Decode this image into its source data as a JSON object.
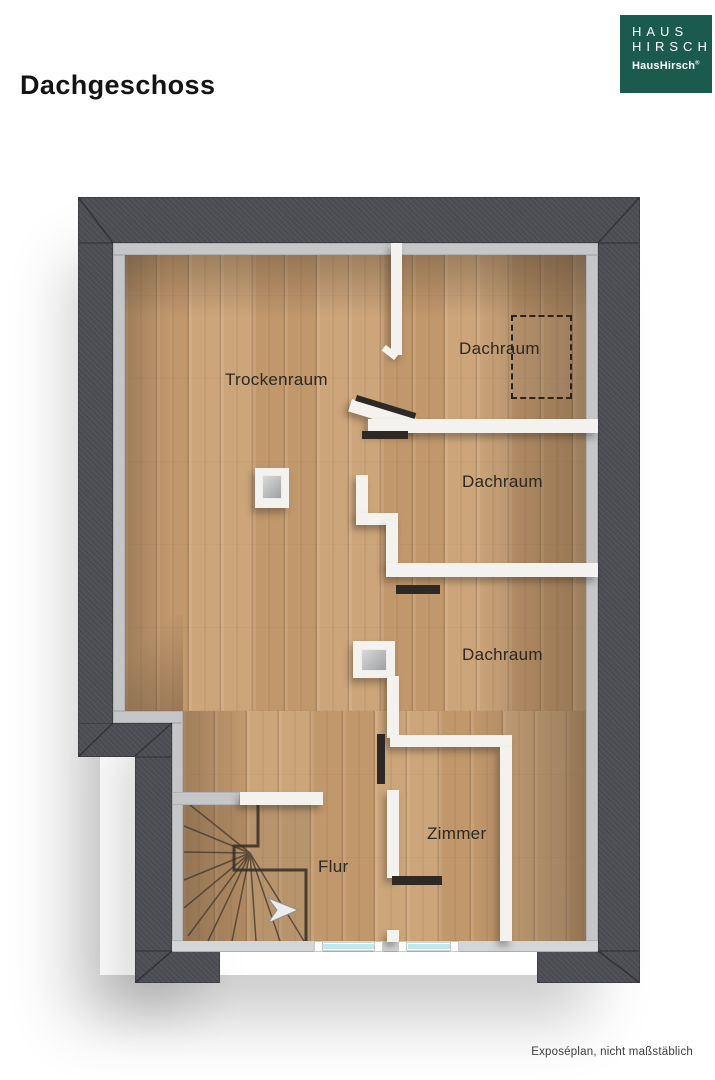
{
  "header": {
    "title": "Dachgeschoss"
  },
  "logo": {
    "line1": "HAUS",
    "line2": "HIRSCH",
    "wordmark": "HausHirsch",
    "trademark": "®"
  },
  "plan": {
    "floor_name": "Dachgeschoss",
    "rooms": [
      {
        "id": "trockenraum",
        "label": "Trockenraum"
      },
      {
        "id": "dachraum-oben",
        "label": "Dachraum"
      },
      {
        "id": "dachraum-mitte",
        "label": "Dachraum"
      },
      {
        "id": "dachraum-unten",
        "label": "Dachraum"
      },
      {
        "id": "zimmer",
        "label": "Zimmer"
      },
      {
        "id": "flur",
        "label": "Flur"
      }
    ],
    "features": [
      "winder-staircase",
      "stair-direction-arrow",
      "two-windows-bottom-wall",
      "chimney-blocks",
      "dashed-roof-hatch-outline"
    ]
  },
  "footer": {
    "note": "Exposéplan, nicht maßstäblich"
  },
  "colors": {
    "roof_band": "#4c4d53",
    "wall_face": "#c5c6c8",
    "floor_wood": "#c79e73",
    "interior_wall": "#f3f2ee",
    "window_glass": "#bfe9ea",
    "logo_green": "#1b5b4d"
  }
}
